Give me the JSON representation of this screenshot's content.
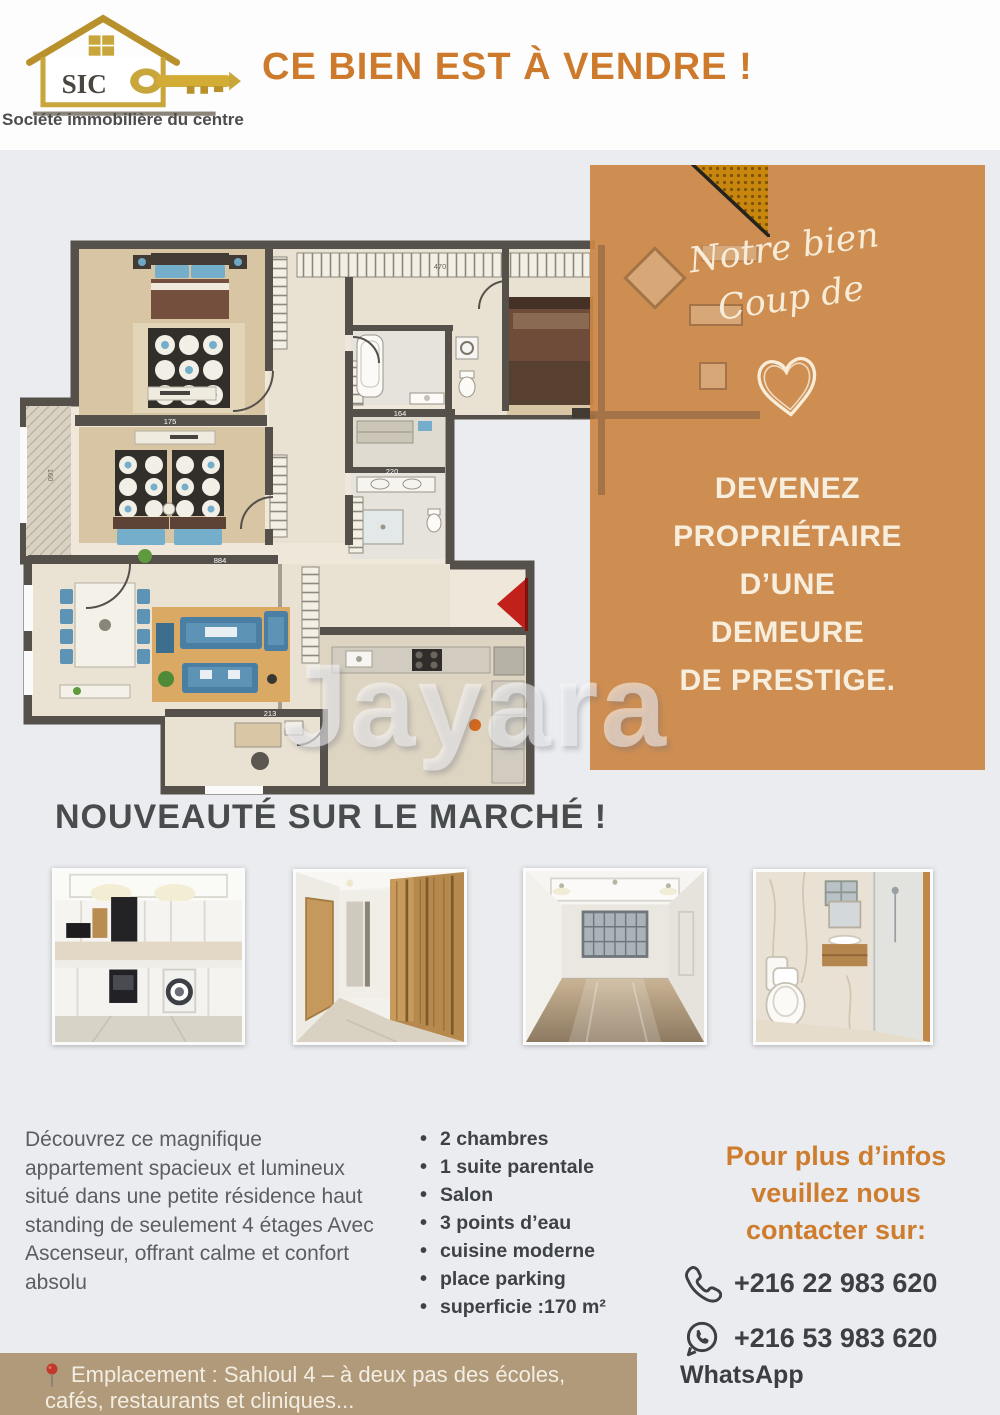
{
  "header": {
    "logo_monogram": "SIC",
    "company_name": "Société immobilière du centre",
    "title": "CE BIEN EST À VENDRE !"
  },
  "promo_panel": {
    "script_line1": "Notre bien",
    "script_line2": "Coup de",
    "headline_lines": [
      "DEVENEZ",
      "PROPRIÉTAIRE",
      "D’UNE",
      "DEMEURE",
      "DE PRESTIGE."
    ]
  },
  "floor_plan": {
    "dims": [
      "175",
      "470",
      "884",
      "220",
      "164",
      "213",
      "160"
    ]
  },
  "watermark": "Jayara",
  "market_headline": "NOUVEAUTÉ SUR LE MARCHÉ !",
  "photos": [
    {
      "name": "cuisine-moderne"
    },
    {
      "name": "couloir-dressing-bois"
    },
    {
      "name": "salon-lumineux"
    },
    {
      "name": "salle-de-bain-marbre"
    }
  ],
  "description": "Découvrez ce magnifique appartement spacieux et lumineux situé dans une petite résidence haut standing de seulement 4 étages Avec Ascenseur, offrant calme et confort absolu",
  "features": [
    "2 chambres",
    "1 suite parentale",
    "Salon",
    "3 points d’eau",
    "cuisine moderne",
    "place parking",
    "superficie :170 m²"
  ],
  "contact": {
    "heading_lines": [
      "Pour plus d’infos",
      "veuillez nous",
      "contacter sur:"
    ],
    "phone_number": "+216 22 983 620",
    "whatsapp_number": "+216 53 983 620",
    "whatsapp_label": "WhatsApp"
  },
  "location_bar": {
    "line1": "Emplacement : Sahloul 4 – à deux pas des écoles,",
    "line2": "cafés, restaurants et cliniques..."
  },
  "colors": {
    "accent_orange": "#cd7a2c",
    "panel_orange": "#cb8646",
    "bar_tan": "#b09a7a",
    "headline_gray": "#484c4c",
    "red_arrow": "#c2201a"
  }
}
